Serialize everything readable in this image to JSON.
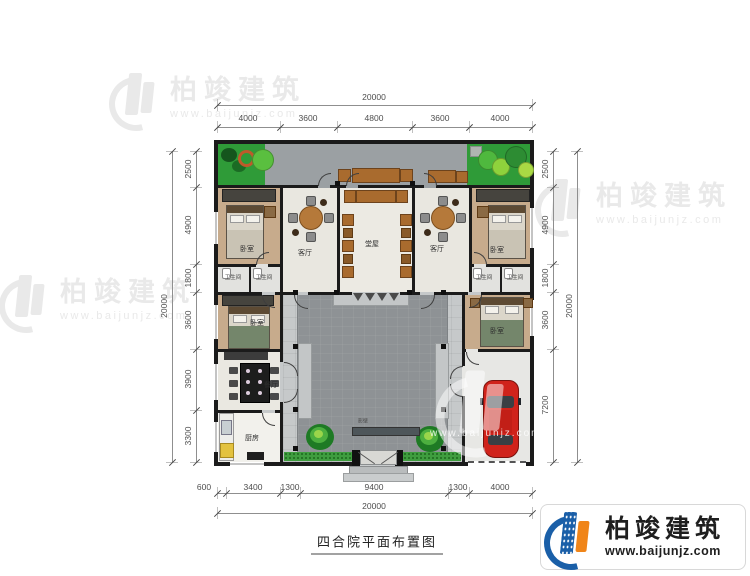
{
  "title": "四合院平面布置图",
  "brand": {
    "name": "柏竣建筑",
    "website": "www.baijunjz.com"
  },
  "watermark": {
    "name": "柏竣建筑",
    "website": "www.baijunjz.com"
  },
  "plan": {
    "rooms": {
      "bedroom_tl": "卧室",
      "living_left": "客厅",
      "main_hall": "堂屋",
      "living_right": "客厅",
      "bedroom_tr": "卧室",
      "bath_l1": "卫生间",
      "bath_l2": "卫生间",
      "bath_r1": "卫生间",
      "bath_r2": "卫生间",
      "bedroom_ml": "卧室",
      "dining": "餐厅",
      "kitchen": "厨房",
      "bedroom_mr": "卧室",
      "screen_wall": "影壁"
    }
  },
  "dimensions": {
    "top": {
      "overall": "20000",
      "segments": [
        "4000",
        "3600",
        "4800",
        "3600",
        "4000"
      ]
    },
    "bottom": {
      "overall": "20000",
      "segments": [
        "600",
        "3400",
        "1300",
        "9400",
        "1300",
        "4000"
      ]
    },
    "left": {
      "overall": "20000",
      "segments": [
        "2500",
        "4900",
        "1800",
        "3600",
        "3900",
        "3300"
      ]
    },
    "right": {
      "overall": "20000",
      "segments": [
        "2500",
        "4900",
        "1800",
        "3600",
        "7200"
      ]
    }
  },
  "colors": {
    "wall": "#1b1b1b",
    "garden_green": "#2f9b38",
    "courtyard_grey": "#8e9295",
    "walkway_grey": "#c6c9ca",
    "wood_floor": "#c7ab8c",
    "car_red": "#d0231b",
    "logo_blue": "#1a5fa8",
    "logo_orange": "#f08519"
  }
}
